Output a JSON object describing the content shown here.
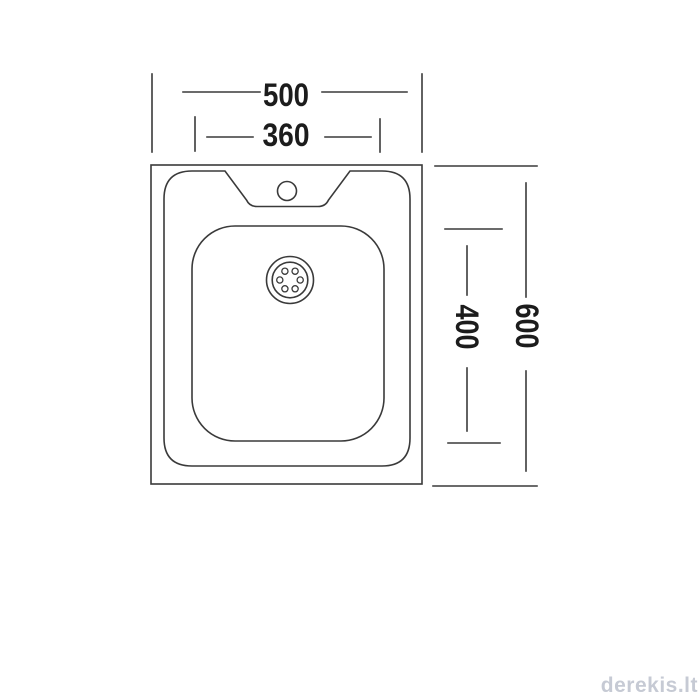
{
  "drawing": {
    "line_color": "#3a3a3a",
    "label_color": "#1c1c1c",
    "dimensions": {
      "overall_width": "500",
      "basin_width": "360",
      "overall_depth": "600",
      "basin_depth": "400"
    }
  },
  "watermark": {
    "text": "derekis.lt",
    "color": "#c6cad4"
  }
}
